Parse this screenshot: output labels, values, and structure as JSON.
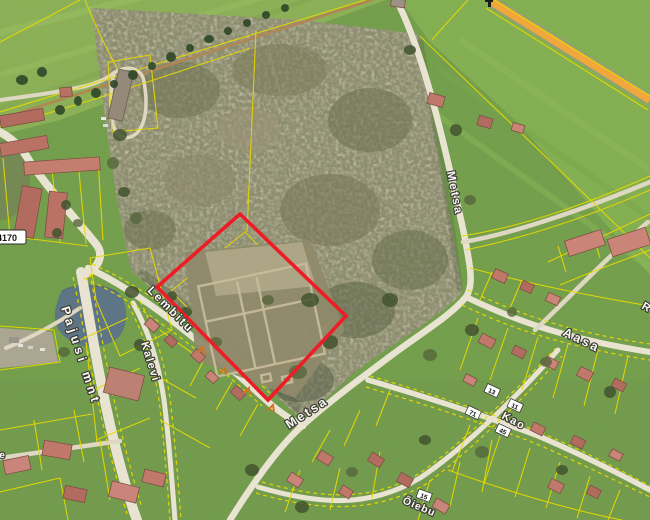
{
  "app": {
    "name": "aerial-cadastral-map-view"
  },
  "map": {
    "street_labels": [
      {
        "name": "Lembitu"
      },
      {
        "name": "Kalevi"
      },
      {
        "name": "Pajusi mnt"
      },
      {
        "name": "Metsa"
      },
      {
        "name": "Metsa"
      },
      {
        "name": "Aasa"
      },
      {
        "name": "Kao"
      },
      {
        "name": "Õiebu"
      },
      {
        "name": "ese"
      },
      {
        "name": "R"
      }
    ],
    "road_number_badge": "4170",
    "house_numbers": [
      {
        "value": "13"
      },
      {
        "value": "11"
      },
      {
        "value": "71"
      },
      {
        "value": "45"
      },
      {
        "value": "15"
      }
    ],
    "colors": {
      "parcel_line": "#e6d800",
      "selection_outline": "#ee1c25",
      "road_fill": "#e9e4d2",
      "highway_orange": "#efa73e",
      "field_green": "#8ab655",
      "forest_base": "#8b8a6d",
      "pond": "#5e7585",
      "roof_red": "#c0786a"
    }
  }
}
